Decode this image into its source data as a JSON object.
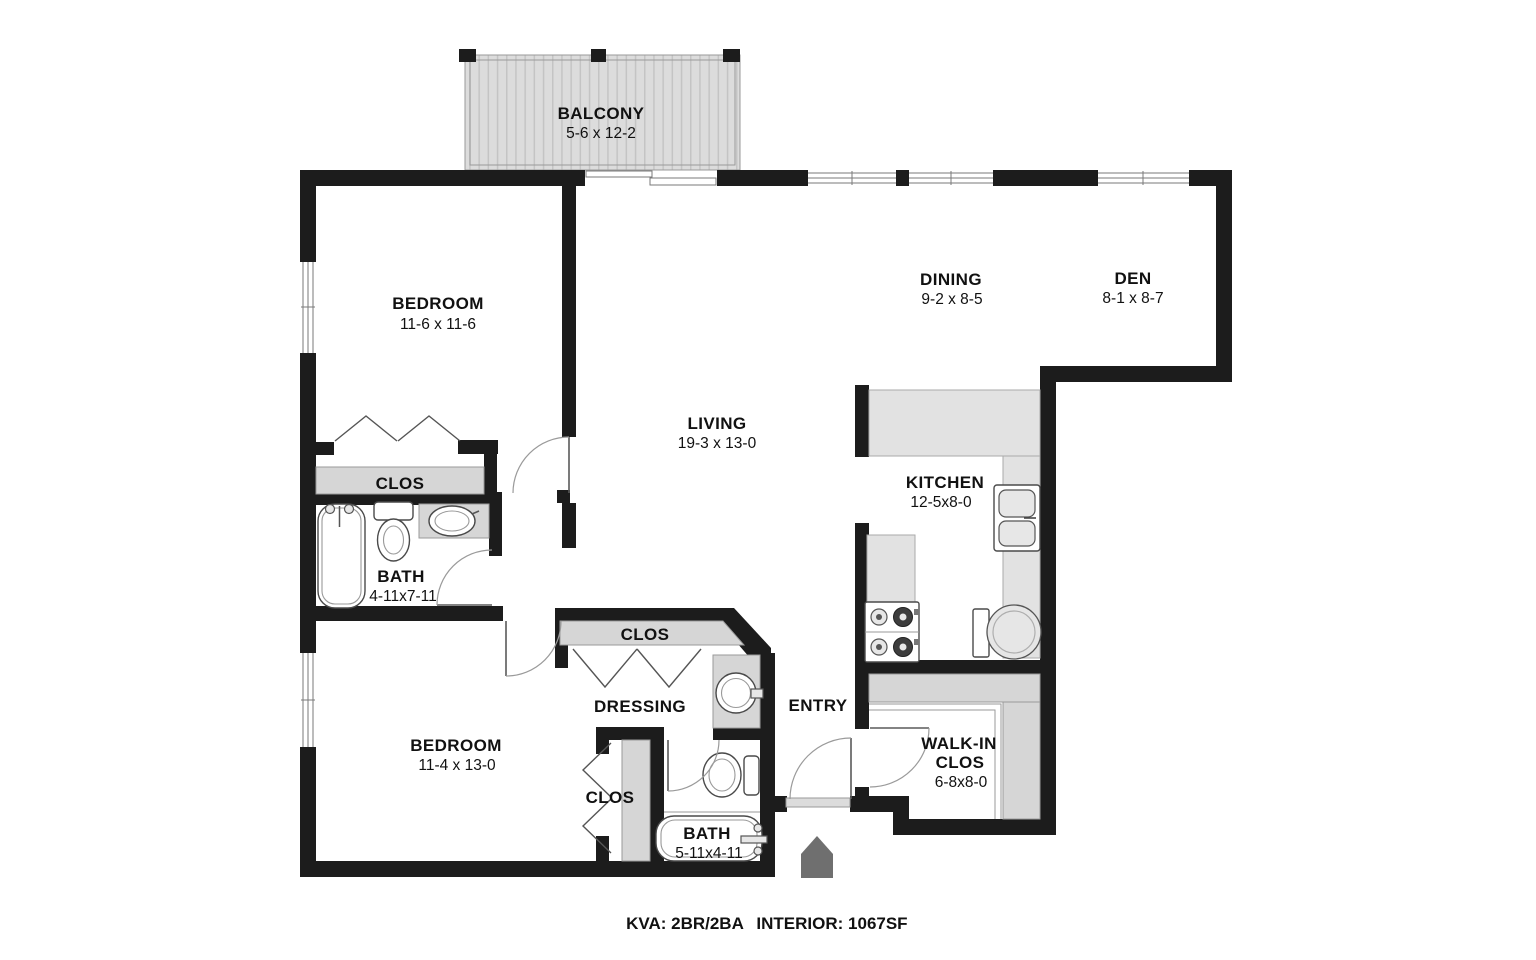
{
  "colors": {
    "wall": "#1c1c1c",
    "shelf": "#d6d6d6",
    "counter": "#e2e2e2",
    "deck": "#dcdcdc",
    "deck_stripe": "#c4c4c4",
    "arrow": "#6f6f6f",
    "ink": "#111111"
  },
  "rooms": {
    "balcony": {
      "name": "BALCONY",
      "dims": "5-6 x 12-2"
    },
    "bedroom1": {
      "name": "BEDROOM",
      "dims": "11-6 x 11-6"
    },
    "dining": {
      "name": "DINING",
      "dims": "9-2 x 8-5"
    },
    "den": {
      "name": "DEN",
      "dims": "8-1 x 8-7"
    },
    "living": {
      "name": "LIVING",
      "dims": "19-3 x 13-0"
    },
    "kitchen": {
      "name": "KITCHEN",
      "dims": "12-5x8-0"
    },
    "closet1": {
      "name": "CLOS"
    },
    "bath1": {
      "name": "BATH",
      "dims": "4-11x7-11"
    },
    "closet2": {
      "name": "CLOS"
    },
    "dressing": {
      "name": "DRESSING"
    },
    "entry": {
      "name": "ENTRY"
    },
    "bedroom2": {
      "name": "BEDROOM",
      "dims": "11-4 x 13-0"
    },
    "closet3": {
      "name": "CLOS"
    },
    "bath2": {
      "name": "BATH",
      "dims": "5-11x4-11"
    },
    "walkin": {
      "name1": "WALK-IN",
      "name2": "CLOS",
      "dims": "6-8x8-0"
    }
  },
  "footer": {
    "left": "KVA: 2BR/2BA",
    "right": "INTERIOR: 1067SF"
  }
}
